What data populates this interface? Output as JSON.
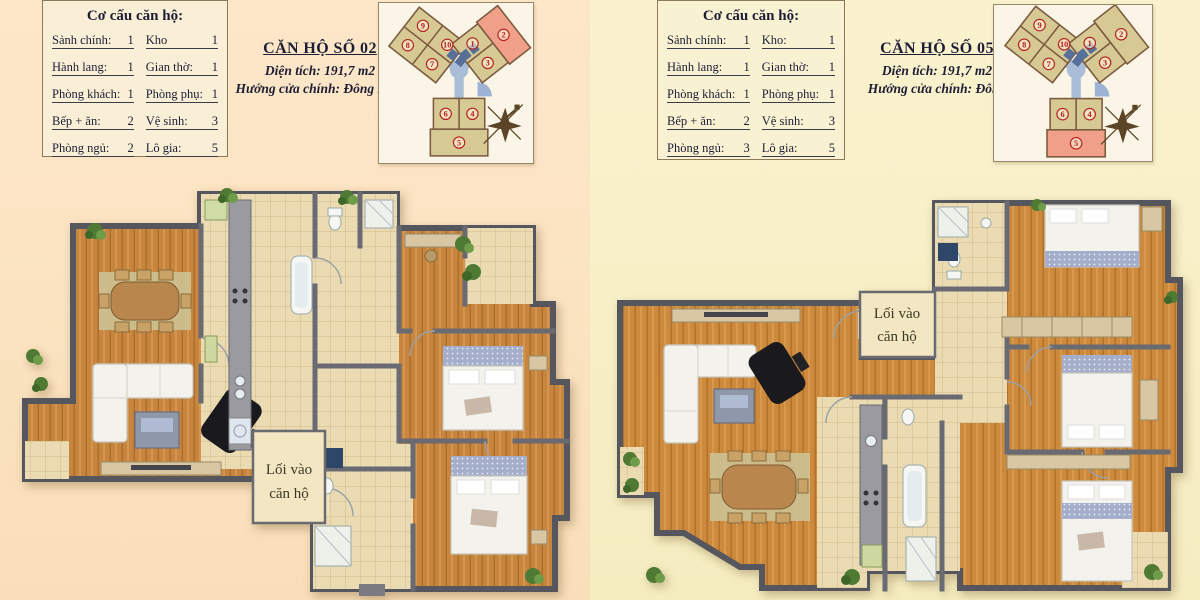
{
  "page": {
    "bg_left": "#fce3c2",
    "bg_right": "#f8f1ca",
    "wood_color": "#c8853e",
    "tile_color": "#eadbb2",
    "wall_color": "#56565e"
  },
  "shared": {
    "keyplan_units": [
      "1",
      "2",
      "3",
      "4",
      "5",
      "6",
      "7",
      "8",
      "9",
      "10"
    ],
    "keyplan_unit_fill": "#d7c993",
    "keyplan_highlight_fill": "#f09f88",
    "keyplan_corridor_color": "#a9bdd6",
    "unit_number_color": "#b32020"
  },
  "apartments": [
    {
      "id": "can-ho-02",
      "composition": {
        "title": "Cơ cấu căn hộ:",
        "rows": [
          {
            "l_label": "Sảnh chính:",
            "l_value": "1",
            "r_label": "Kho",
            "r_value": "1"
          },
          {
            "l_label": "Hành lang:",
            "l_value": "1",
            "r_label": "Gian thờ:",
            "r_value": "1"
          },
          {
            "l_label": "Phòng khách:",
            "l_value": "1",
            "r_label": "Phòng phụ:",
            "r_value": "1"
          },
          {
            "l_label": "Bếp + ăn:",
            "l_value": "2",
            "r_label": "Vệ sinh:",
            "r_value": "3"
          },
          {
            "l_label": "Phòng ngủ:",
            "l_value": "2",
            "r_label": "Lô gia:",
            "r_value": "5"
          }
        ]
      },
      "header": {
        "title": "CĂN HỘ SỐ 02",
        "area": "Diện tích: 191,7 m2",
        "direction": "Hướng cửa chính: Đông Nam"
      },
      "keyplan": {
        "highlighted_unit": "2",
        "unit2_fill": "#f09f88",
        "unit5_fill": "#d7c993"
      },
      "plan": {
        "entrance_line1": "Lối vào",
        "entrance_line2": "căn hộ"
      }
    },
    {
      "id": "can-ho-05",
      "composition": {
        "title": "Cơ cấu căn hộ:",
        "rows": [
          {
            "l_label": "Sảnh chính:",
            "l_value": "1",
            "r_label": "Kho:",
            "r_value": "1"
          },
          {
            "l_label": "Hành lang:",
            "l_value": "1",
            "r_label": "Gian thờ:",
            "r_value": "1"
          },
          {
            "l_label": "Phòng khách:",
            "l_value": "1",
            "r_label": "Phòng phụ:",
            "r_value": "1"
          },
          {
            "l_label": "Bếp + ăn:",
            "l_value": "2",
            "r_label": "Vệ sinh:",
            "r_value": "3"
          },
          {
            "l_label": "Phòng ngủ:",
            "l_value": "3",
            "r_label": "Lô gia:",
            "r_value": "5"
          }
        ]
      },
      "header": {
        "title": "CĂN HỘ SỐ 05",
        "area": "Diện tích: 191,7 m2",
        "direction": "Hướng cửa chính: Đông"
      },
      "keyplan": {
        "highlighted_unit": "5",
        "unit2_fill": "#d7c993",
        "unit5_fill": "#f09f88"
      },
      "plan": {
        "entrance_line1": "Lối vào",
        "entrance_line2": "căn hộ"
      }
    }
  ]
}
